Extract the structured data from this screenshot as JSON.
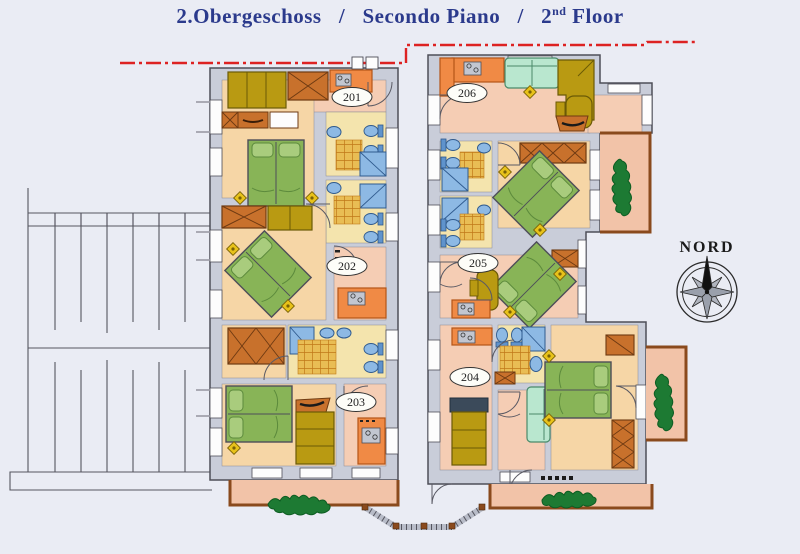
{
  "title": {
    "german": "2.Obergeschoss",
    "separator1": "/",
    "italian": "Secondo Piano",
    "separator2": "/",
    "english_number": "2",
    "english_ordinal": "nd",
    "english_word": "Floor",
    "color": "#2b3a8c"
  },
  "compass": {
    "label": "NORD"
  },
  "rooms": [
    {
      "number": "201"
    },
    {
      "number": "202"
    },
    {
      "number": "203"
    },
    {
      "number": "204"
    },
    {
      "number": "205"
    },
    {
      "number": "206"
    }
  ],
  "palette": {
    "wall": "#c9cdd9",
    "floor_salmon": "#f5cdb4",
    "floor_tan": "#f6d6a6",
    "floor_bath": "#f4e4ad",
    "bed_green": "#88b457",
    "sofa_mint": "#b9e7cf",
    "kitchen_orange": "#f08a45",
    "wardrobe_brown": "#c8712c",
    "closet_mustard": "#b99a12",
    "fixture_blue": "#8db9e4",
    "plant_green": "#1d7a33",
    "boundary_red": "#dd2222",
    "balcony_border": "#8a4a1d"
  }
}
